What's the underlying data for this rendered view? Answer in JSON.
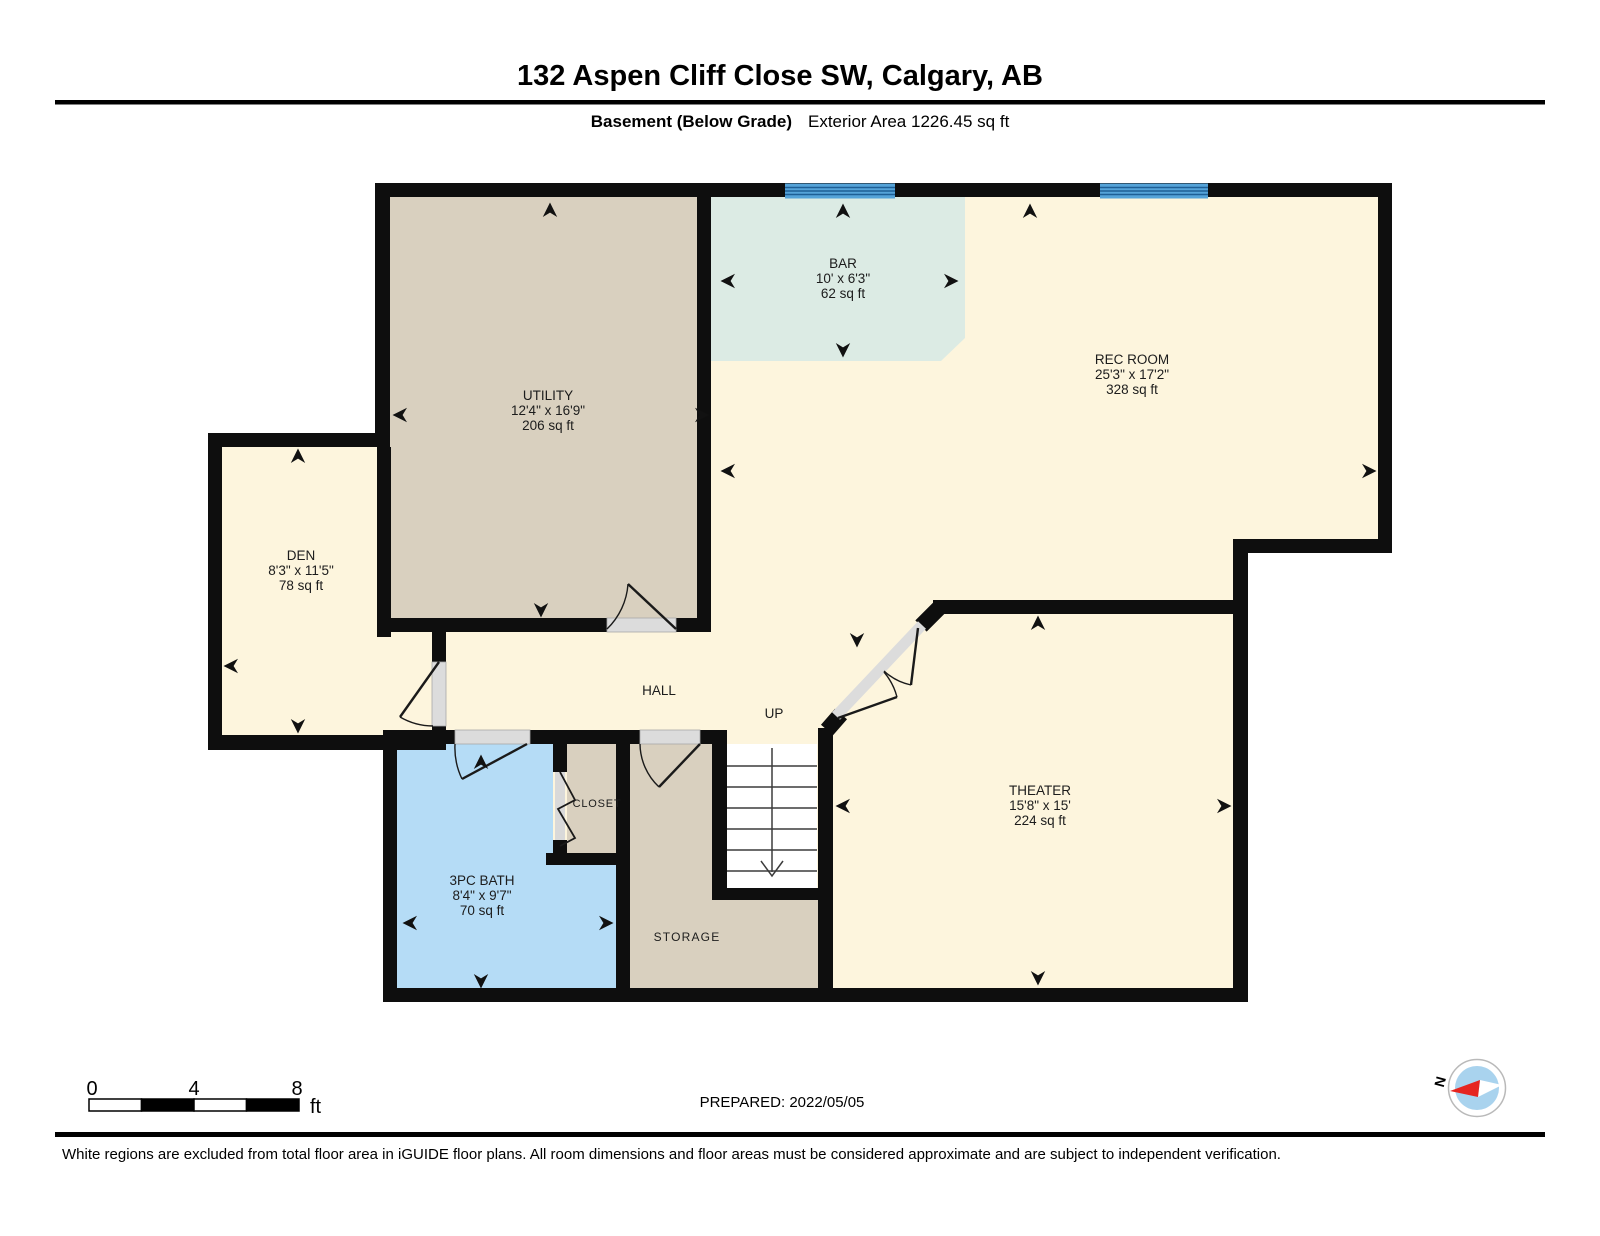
{
  "header": {
    "title": "132 Aspen Cliff Close SW, Calgary, AB",
    "floor_label": "Basement (Below Grade)",
    "area_label": "Exterior Area 1226.45 sq ft"
  },
  "rooms": {
    "utility": {
      "name": "UTILITY",
      "dims": "12'4\" x 16'9\"",
      "area": "206 sq ft"
    },
    "den": {
      "name": "DEN",
      "dims": "8'3\" x 11'5\"",
      "area": "78 sq ft"
    },
    "bar": {
      "name": "BAR",
      "dims": "10' x 6'3\"",
      "area": "62 sq ft"
    },
    "rec_room": {
      "name": "REC ROOM",
      "dims": "25'3\" x 17'2\"",
      "area": "328 sq ft"
    },
    "theater": {
      "name": "THEATER",
      "dims": "15'8\" x 15'",
      "area": "224 sq ft"
    },
    "bath": {
      "name": "3PC BATH",
      "dims": "8'4\" x 9'7\"",
      "area": "70 sq ft"
    },
    "hall": {
      "name": "HALL"
    },
    "stairs": {
      "name": "UP"
    },
    "closet": {
      "name": "CLOSET"
    },
    "storage": {
      "name": "STORAGE"
    }
  },
  "scale_bar": {
    "ticks": [
      "0",
      "4",
      "8"
    ],
    "unit": "ft"
  },
  "compass": {
    "north_label": "N"
  },
  "footer": {
    "prepared": "PREPARED: 2022/05/05",
    "disclaimer": "White regions are excluded from total floor area in iGUIDE floor plans. All room dimensions and floor areas must be considered approximate and are subject to independent verification."
  },
  "colors": {
    "wall": "#0e0e0e",
    "floor_cream": "#fdf5dd",
    "floor_beige": "#d9d0bf",
    "floor_teal": "#dcebe4",
    "floor_blue": "#b5dcf6",
    "window_blue": "#55a3d8",
    "window_line": "#1e5f96",
    "door_gray": "#dcdcdc",
    "track_gray": "#d9d9d9",
    "compass_blue": "#a9d3ee",
    "compass_red": "#e62520"
  }
}
